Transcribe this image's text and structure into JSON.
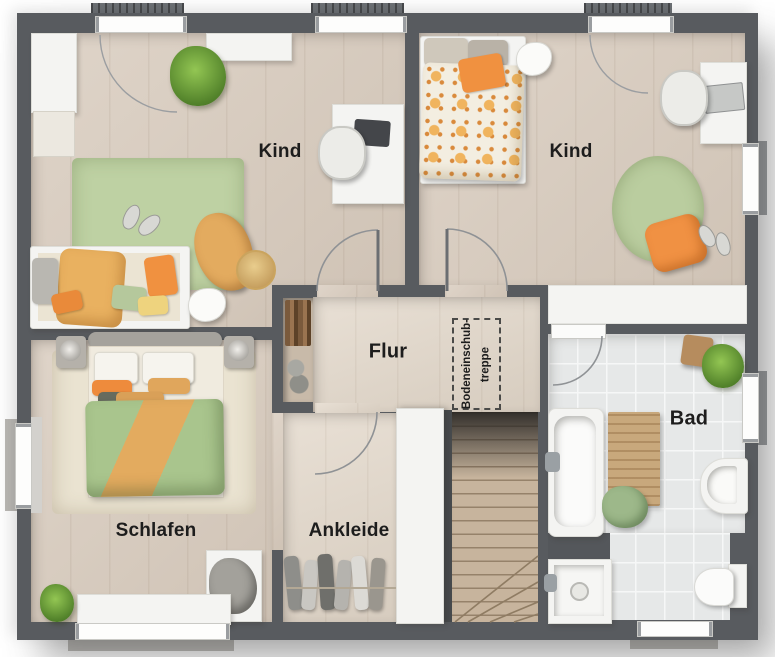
{
  "rooms": {
    "kind_left": {
      "label": "Kind"
    },
    "kind_right": {
      "label": "Kind"
    },
    "flur": {
      "label": "Flur"
    },
    "schlafen": {
      "label": "Schlafen"
    },
    "ankleide": {
      "label": "Ankleide"
    },
    "bad": {
      "label": "Bad"
    }
  },
  "annotations": {
    "attic_ladder": {
      "line1": "Bodeneinschub-",
      "line2": "treppe"
    }
  },
  "colors": {
    "wall": "#585b5f",
    "floor_wood": "#d8cbbd",
    "floor_flur": "#e2d7c9",
    "floor_tile_bath": "#e6e8e8",
    "stair_wood": "#c7b49d",
    "rug_green": "#bed1a3",
    "rug_cream": "#eae3d1",
    "duvet_green": "#a9c58d",
    "accent_mustard": "#e3ab5f",
    "accent_orange": "#ef9140",
    "white_furniture": "#f4f4f2"
  }
}
